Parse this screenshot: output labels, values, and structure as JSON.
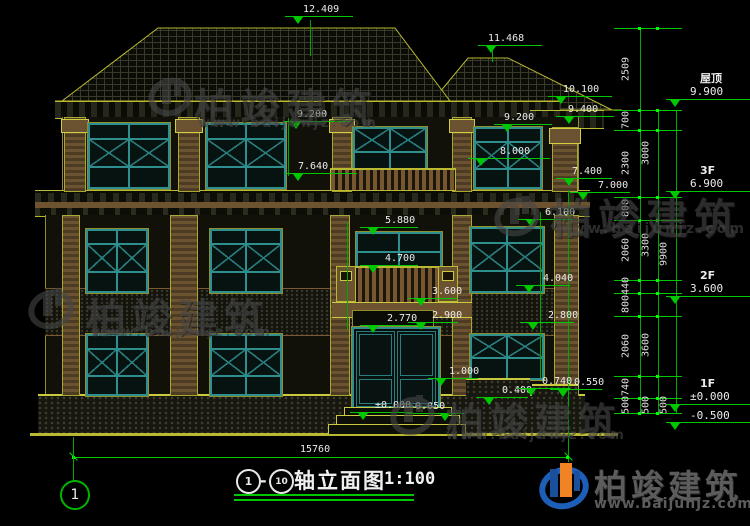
{
  "watermark": {
    "name": "柏竣建筑",
    "url": "www.baijunjz.com"
  },
  "title_block": {
    "axis_start": "1",
    "separator": "-",
    "axis_end": "10",
    "name": "轴立面图",
    "scale": "1:100"
  },
  "bottom": {
    "total_dim": "15760",
    "axis_bubble": "1"
  },
  "floor_labels": {
    "roof": {
      "name": "屋顶",
      "elev": "9.900"
    },
    "f3": {
      "name": "3F",
      "elev": "6.900"
    },
    "f2": {
      "name": "2F",
      "elev": "3.600"
    },
    "f1": {
      "name": "1F",
      "elev": "±0.000",
      "below": "-0.500"
    }
  },
  "elevation_markers": [
    {
      "value": "12.409"
    },
    {
      "value": "11.468"
    },
    {
      "value": "10.100"
    },
    {
      "value": "9.400"
    },
    {
      "value": "9.200"
    },
    {
      "value": "9.200"
    },
    {
      "value": "8.000"
    },
    {
      "value": "7.640"
    },
    {
      "value": "7.400"
    },
    {
      "value": "7.000"
    },
    {
      "value": "5.880"
    },
    {
      "value": "4.700"
    },
    {
      "value": "6.100"
    },
    {
      "value": "4.040"
    },
    {
      "value": "3.600"
    },
    {
      "value": "2.900"
    },
    {
      "value": "2.770"
    },
    {
      "value": "2.800"
    },
    {
      "value": "1.000"
    },
    {
      "value": "0.400"
    },
    {
      "value": "0.740"
    },
    {
      "value": "0.550"
    },
    {
      "value": "±0.000"
    },
    {
      "value": "-0.050"
    }
  ],
  "dim_chains": {
    "chain1": [
      "2509",
      "700",
      "2300",
      "800",
      "2060",
      "440",
      "800",
      "2060",
      "740",
      "500"
    ],
    "chain2": [
      "3000",
      "3300",
      "3600",
      "500"
    ],
    "chain3": [
      "9900",
      "500"
    ]
  },
  "colors": {
    "background": "#000000",
    "dim_green": "#00c800",
    "outline_yellow": "#b9b932",
    "window_teal": "#2f8f8f",
    "trim_brown": "#6b5230",
    "text_white": "#ececec",
    "logo_blue": "#1d5fb8",
    "logo_orange": "#f08324",
    "watermark_gray": "#474747"
  }
}
